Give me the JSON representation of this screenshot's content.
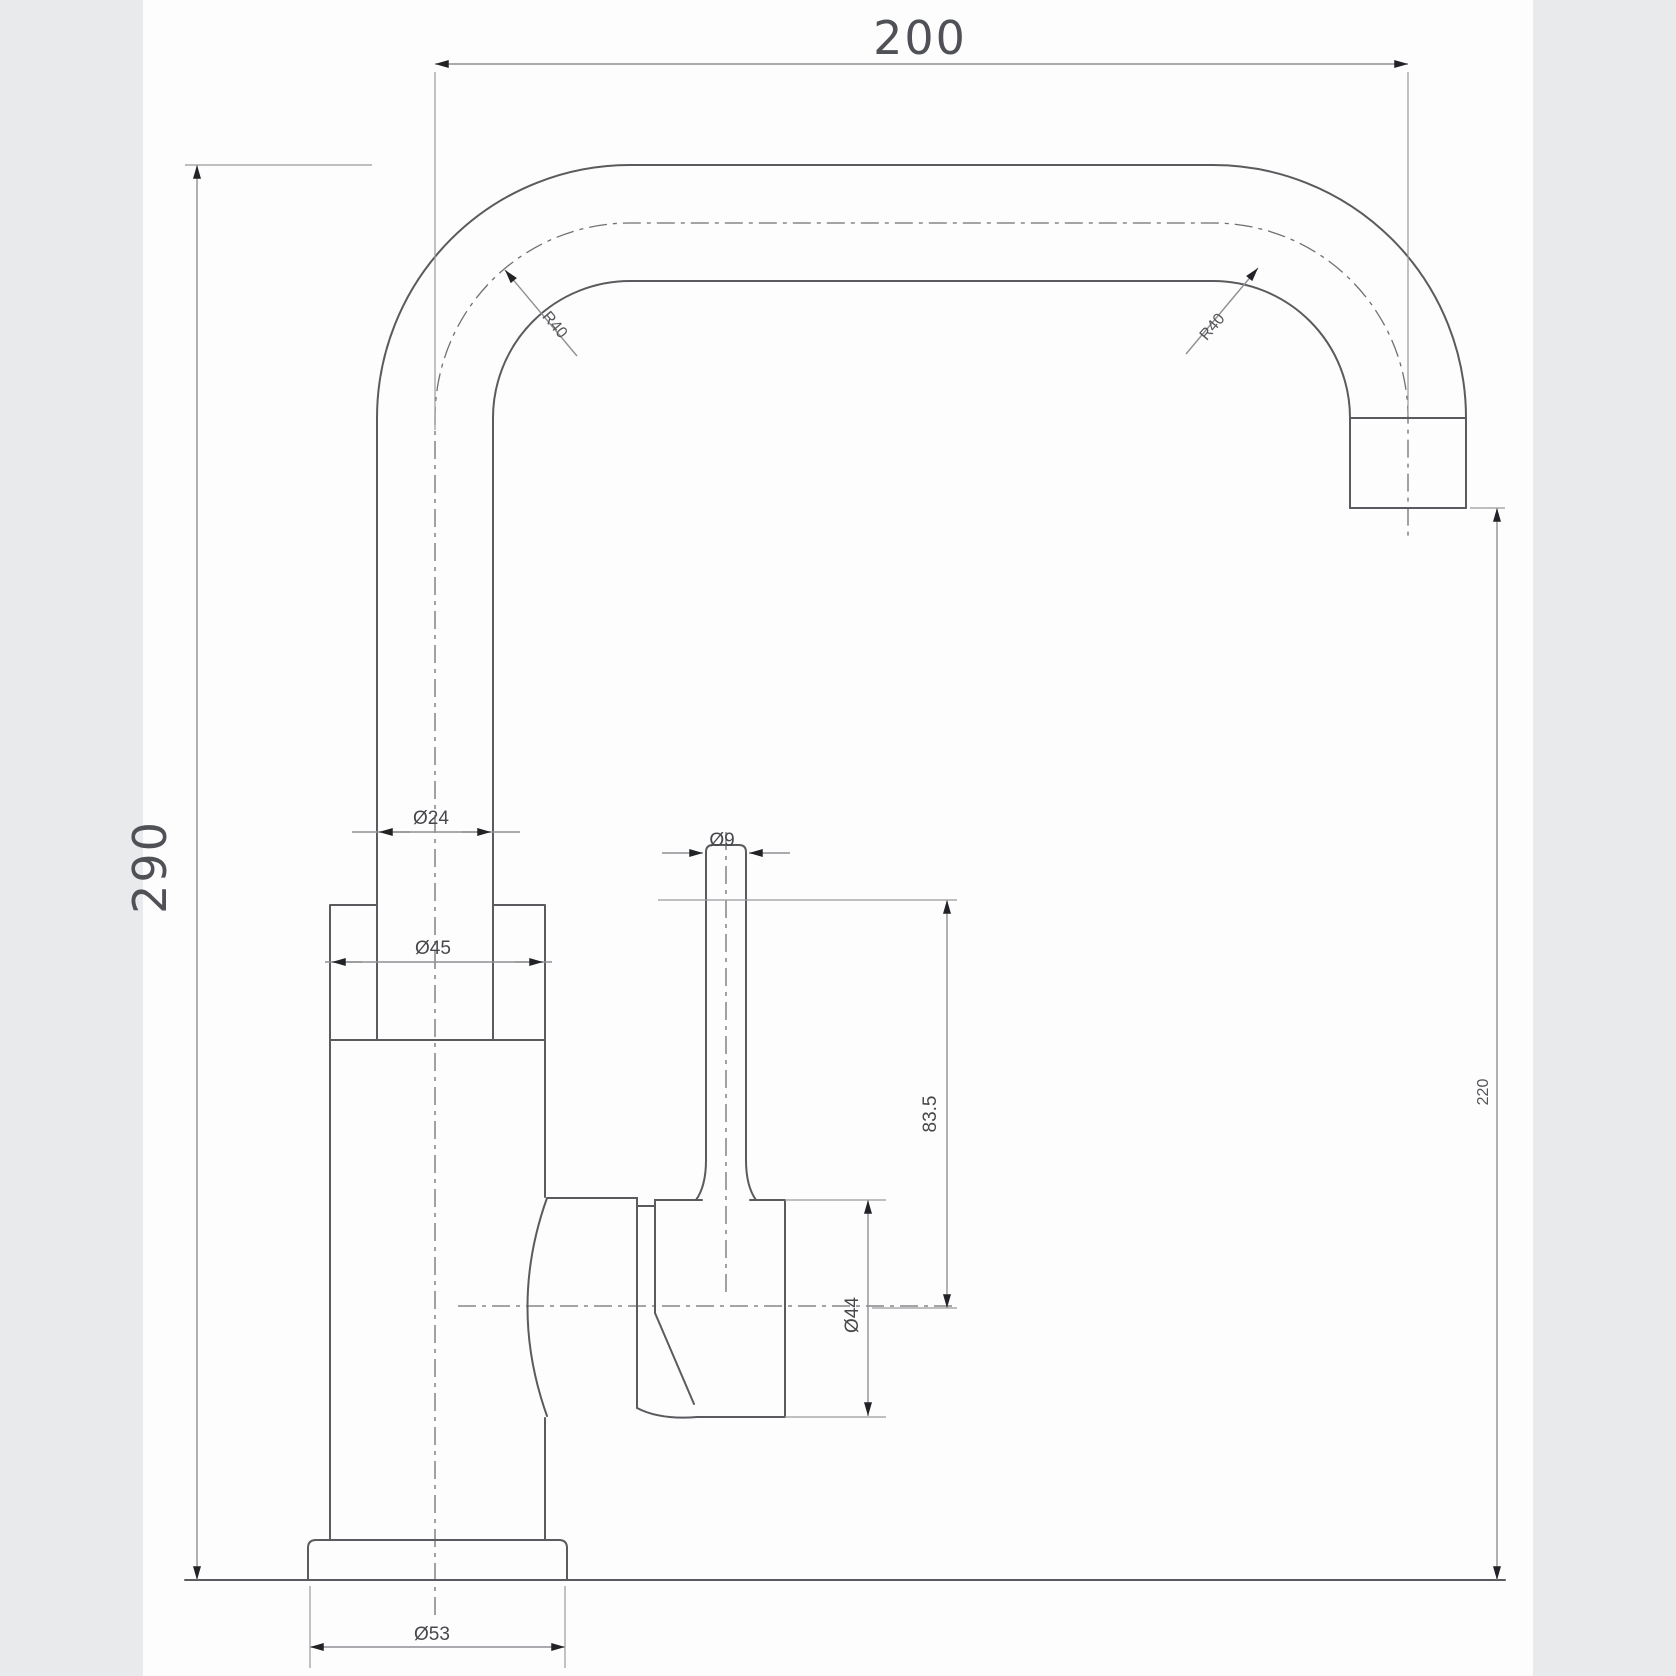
{
  "title": "Faucet technical drawing",
  "drawing": {
    "labels": {
      "width": "200",
      "height": "290",
      "spout_outlet_height": "220",
      "bend_radius_left": "R40",
      "bend_radius_right": "R40",
      "spout_tube_diameter": "Ø24",
      "body_diameter": "Ø45",
      "lever_diameter": "Ø9",
      "cartridge_diameter": "Ø44",
      "base_diameter": "Ø53",
      "lever_height": "83.5"
    },
    "colors": {
      "page_background": "#e8eaec",
      "canvas": "#fdfdfd",
      "object_line": "#5a5b5e",
      "dimension_line": "#8f9093",
      "arrow": "#222326",
      "text": "#4f5157"
    }
  }
}
